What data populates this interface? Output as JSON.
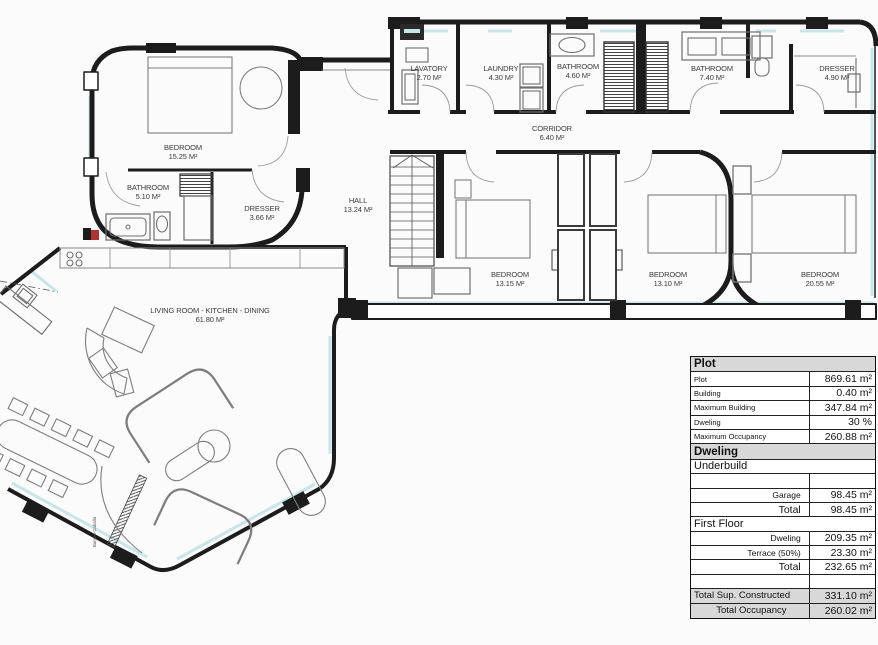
{
  "rooms": [
    {
      "name": "BEDROOM",
      "area": "15.25 M²"
    },
    {
      "name": "BATHROOM",
      "area": "5.10 M²"
    },
    {
      "name": "DRESSER",
      "area": "3.66 M²"
    },
    {
      "name": "LAVATORY",
      "area": "2.70 M²"
    },
    {
      "name": "LAUNDRY",
      "area": "4.30 M²"
    },
    {
      "name": "BATHROOM",
      "area": "4.60 M²"
    },
    {
      "name": "CORRIDOR",
      "area": "6.40 M²"
    },
    {
      "name": "BATHROOM",
      "area": "7.40 M²"
    },
    {
      "name": "DRESSER",
      "area": "4.90 M²"
    },
    {
      "name": "HALL",
      "area": "13.24 M²"
    },
    {
      "name": "BEDROOM",
      "area": "13.15 M²"
    },
    {
      "name": "BEDROOM",
      "area": "13.10 M²"
    },
    {
      "name": "BEDROOM",
      "area": "20.55 M²"
    },
    {
      "name": "LIVING ROOM - KITCHEN - DINING",
      "area": "61.80 M²"
    }
  ],
  "annotations": {
    "vertical_note": "Bambo-Caballa"
  },
  "colors": {
    "window": "#c7e6ea",
    "wall": "#1c1c1c",
    "furniture": "#7d7d7d",
    "red_marker": "#b23030",
    "table_header_bg": "#d8d8d8"
  },
  "table": {
    "rows": [
      {
        "kind": "header",
        "label": "Plot"
      },
      {
        "kind": "data",
        "label": "Plot",
        "value": "869.61 m²",
        "style": "small-left"
      },
      {
        "kind": "data",
        "label": "Building",
        "value": "0.40 m²",
        "style": "small-left"
      },
      {
        "kind": "data",
        "label": "Maximum Building",
        "value": "347.84 m²",
        "style": "small-left"
      },
      {
        "kind": "data",
        "label": "Dweling",
        "value": "30 %",
        "style": "small-left"
      },
      {
        "kind": "data",
        "label": "Maximum Occupancy",
        "value": "260.88 m²",
        "style": "small-left"
      },
      {
        "kind": "header",
        "label": "Dweling"
      },
      {
        "kind": "subheader",
        "label": "Underbuild"
      },
      {
        "kind": "data",
        "label": "",
        "value": "",
        "style": "small-left"
      },
      {
        "kind": "data",
        "label": "Garage",
        "value": "98.45 m²",
        "style": "small-right"
      },
      {
        "kind": "data",
        "label": "Total",
        "value": "98.45 m²",
        "style": "big-right"
      },
      {
        "kind": "subheader",
        "label": "First Floor"
      },
      {
        "kind": "data",
        "label": "Dweling",
        "value": "209.35 m²",
        "style": "small-right"
      },
      {
        "kind": "data",
        "label": "Terrace (50%)",
        "value": "23.30 m²",
        "style": "small-right"
      },
      {
        "kind": "data",
        "label": "Total",
        "value": "232.65 m²",
        "style": "big-right"
      },
      {
        "kind": "data",
        "label": "",
        "value": "",
        "style": "small-left"
      },
      {
        "kind": "data",
        "label": "Total Sup. Constructed",
        "value": "331.10 m²",
        "style": "big-left",
        "shade": true
      },
      {
        "kind": "data",
        "label": "Total Occupancy",
        "value": "260.02 m²",
        "style": "big-center",
        "shade": true
      }
    ]
  }
}
